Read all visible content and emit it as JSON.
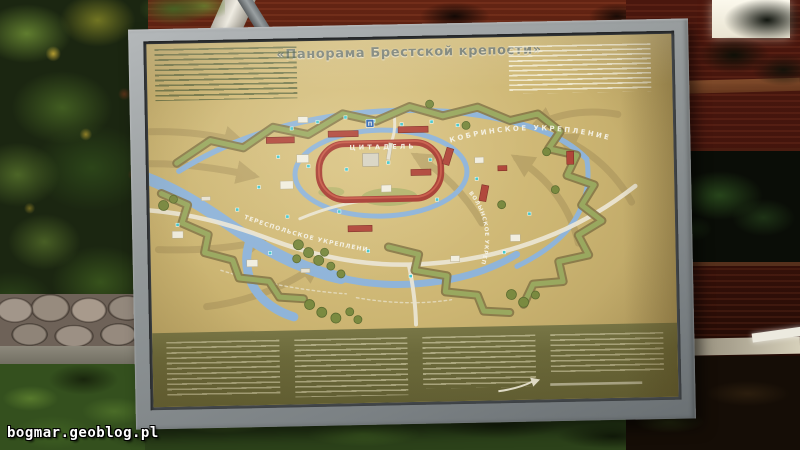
{
  "photo": {
    "watermark": "bogmar.geoblog.pl"
  },
  "board": {
    "title": "«Панорама Брестской крепости»",
    "map": {
      "labels": {
        "citadel": "ЦИТАДЕЛЬ",
        "kobrin": "КОБРИНСКОЕ УКРЕПЛЕНИЕ",
        "terespol": "ТЕРЕСПОЛЬСКОЕ УКРЕПЛЕНИЕ",
        "volyn": "ВОЛЫНСКОЕ УКРЕПЛЕНИЕ",
        "parking": "П"
      },
      "colors": {
        "land": "#ccb572",
        "river": "#8fb4d9",
        "road": "#ece7d6",
        "rampart": "#99a85f",
        "barracks_red": "#a83d33",
        "attack_arrow": "#a5905a",
        "tree": "#7a8a40",
        "marker_teal": "#45c8cc",
        "legend_band": "#6c6a3b",
        "frame_gray": "#939899"
      }
    }
  }
}
